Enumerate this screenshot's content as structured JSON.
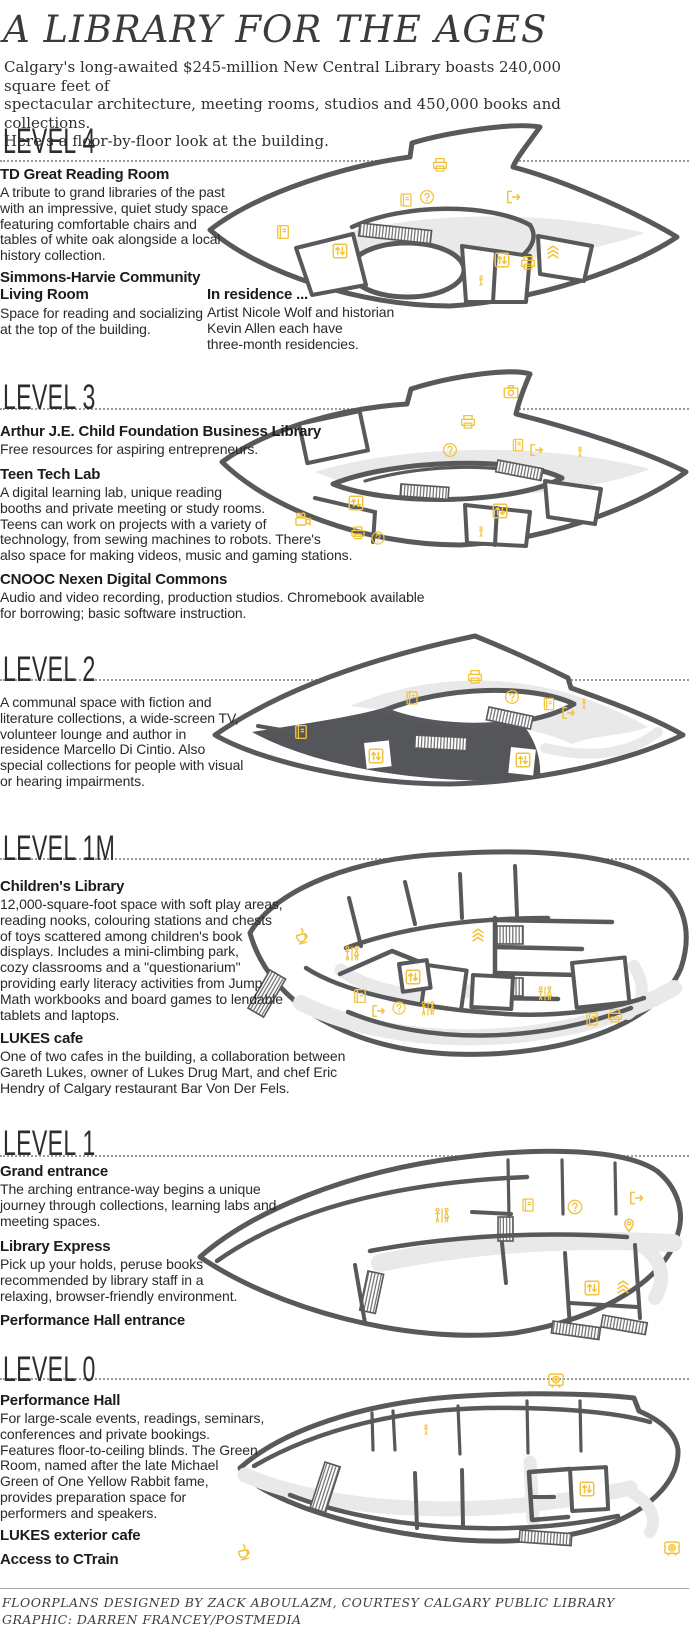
{
  "title": "A LIBRARY FOR THE AGES",
  "intro": "Calgary's long-awaited $245-million New Central Library boasts 240,000 square feet of\nspectacular architecture, meeting rooms, studios and 450,000 books and collections.\nHere's a floor-by-floor look at the building.",
  "colors": {
    "accent": "#f2c33c",
    "wall": "#58595b",
    "band": "#e9e9ea",
    "dark_fill": "#55565a"
  },
  "sections": [
    {
      "id": "level4",
      "label": "LEVEL 4",
      "blocks": [
        {
          "heading": "TD Great Reading Room",
          "body": "A tribute to grand libraries of the past\nwith an impressive, quiet study space\nfeaturing comfortable chairs and\ntables of white oak alongside a local\nhistory collection."
        },
        {
          "heading": "Simmons-Harvie Community\nLiving Room",
          "body": "Space for reading and socializing\nat the top of the building."
        },
        {
          "heading": "In residence ...",
          "body": "Artist Nicole Wolf and historian\nKevin Allen each have\nthree-month residencies."
        }
      ],
      "icons": [
        {
          "type": "printer",
          "x": 240,
          "y": 50,
          "s": 18
        },
        {
          "type": "book",
          "x": 206,
          "y": 85,
          "s": 17
        },
        {
          "type": "question",
          "x": 227,
          "y": 82,
          "s": 17
        },
        {
          "type": "exit",
          "x": 313,
          "y": 82,
          "s": 18
        },
        {
          "type": "book",
          "x": 83,
          "y": 117,
          "s": 18
        },
        {
          "type": "elevator",
          "x": 140,
          "y": 136,
          "s": 19
        },
        {
          "type": "elevator",
          "x": 302,
          "y": 145,
          "s": 19
        },
        {
          "type": "printer",
          "x": 328,
          "y": 148,
          "s": 18
        },
        {
          "type": "stairs",
          "x": 353,
          "y": 136,
          "s": 18
        },
        {
          "type": "person",
          "x": 281,
          "y": 166,
          "s": 13
        }
      ]
    },
    {
      "id": "level3",
      "label": "LEVEL 3",
      "blocks": [
        {
          "heading": "Arthur J.E. Child Foundation Business Library",
          "body": "Free resources for aspiring entrepreneurs."
        },
        {
          "heading": "Teen Tech Lab",
          "body": "A digital learning lab, unique reading\nbooths and private meeting or study rooms.\nTeens can work on projects with a variety of\ntechnology, from sewing machines to robots. There's\nalso space for making videos, music and gaming stations."
        },
        {
          "heading": "CNOOC Nexen Digital Commons",
          "body": "Audio and video recording, production studios. Chromebook available\nfor borrowing; basic software instruction."
        }
      ],
      "icons": [
        {
          "type": "camera",
          "x": 296,
          "y": 30,
          "s": 19
        },
        {
          "type": "printer",
          "x": 253,
          "y": 60,
          "s": 18
        },
        {
          "type": "question",
          "x": 235,
          "y": 88,
          "s": 17
        },
        {
          "type": "book",
          "x": 303,
          "y": 83,
          "s": 16
        },
        {
          "type": "exit",
          "x": 321,
          "y": 88,
          "s": 17
        },
        {
          "type": "person",
          "x": 365,
          "y": 90,
          "s": 13
        },
        {
          "type": "elevator",
          "x": 141,
          "y": 141,
          "s": 19
        },
        {
          "type": "elevator",
          "x": 285,
          "y": 149,
          "s": 19
        },
        {
          "type": "video",
          "x": 88,
          "y": 158,
          "s": 20
        },
        {
          "type": "printer",
          "x": 143,
          "y": 171,
          "s": 17
        },
        {
          "type": "question",
          "x": 163,
          "y": 176,
          "s": 16
        },
        {
          "type": "person",
          "x": 266,
          "y": 170,
          "s": 13
        }
      ]
    },
    {
      "id": "level2",
      "label": "LEVEL 2",
      "blocks": [
        {
          "heading": "",
          "body": "A communal space with fiction and\nliterature collections, a wide-screen TV,\nvolunteer lounge and author in\nresidence Marcello Di Cintio. Also\nspecial collections for people with visual\nor hearing impairments."
        }
      ],
      "icons": [
        {
          "type": "printer",
          "x": 275,
          "y": 67,
          "s": 18
        },
        {
          "type": "book",
          "x": 212,
          "y": 88,
          "s": 17
        },
        {
          "type": "question",
          "x": 312,
          "y": 87,
          "s": 17
        },
        {
          "type": "book",
          "x": 349,
          "y": 94,
          "s": 16
        },
        {
          "type": "exit",
          "x": 368,
          "y": 103,
          "s": 17
        },
        {
          "type": "person",
          "x": 384,
          "y": 94,
          "s": 13
        },
        {
          "type": "book",
          "x": 101,
          "y": 122,
          "s": 18
        },
        {
          "type": "elevator",
          "x": 176,
          "y": 146,
          "s": 19
        },
        {
          "type": "elevator",
          "x": 323,
          "y": 150,
          "s": 19
        }
      ]
    },
    {
      "id": "level1m",
      "label": "LEVEL 1M",
      "blocks": [
        {
          "heading": "Children's Library",
          "body": "12,000-square-foot space with soft play areas,\nreading nooks, colouring stations and chests\nof toys scattered among children's book\ndisplays. Includes a mini-climbing park,\ncozy classrooms and a \"questionarium\"\nproviding early literacy activities from Jump\nMath workbooks and board games to lendable\ntablets and laptops."
        },
        {
          "heading": "LUKES cafe",
          "body": "One of two cafes in the building, a collaboration between\nGareth Lukes, owner of Lukes Drug Mart, and chef Eric\nHendry of Calgary restaurant Bar Von Der Fels."
        }
      ],
      "icons": [
        {
          "type": "coffee",
          "x": 56,
          "y": 88,
          "s": 20
        },
        {
          "type": "washroom",
          "x": 106,
          "y": 106,
          "s": 20
        },
        {
          "type": "stairs",
          "x": 232,
          "y": 86,
          "s": 18
        },
        {
          "type": "elevator",
          "x": 167,
          "y": 129,
          "s": 19
        },
        {
          "type": "book",
          "x": 114,
          "y": 148,
          "s": 18
        },
        {
          "type": "exit",
          "x": 132,
          "y": 163,
          "s": 17
        },
        {
          "type": "question",
          "x": 153,
          "y": 160,
          "s": 16
        },
        {
          "type": "washroom",
          "x": 182,
          "y": 161,
          "s": 19
        },
        {
          "type": "washroom",
          "x": 299,
          "y": 146,
          "s": 19
        },
        {
          "type": "book",
          "x": 346,
          "y": 171,
          "s": 17
        },
        {
          "type": "printer",
          "x": 369,
          "y": 168,
          "s": 18
        }
      ]
    },
    {
      "id": "level1",
      "label": "LEVEL 1",
      "blocks": [
        {
          "heading": "Grand entrance",
          "body": "The arching entrance-way begins a unique\njourney through collections, learning labs and\nmeeting spaces."
        },
        {
          "heading": "Library Express",
          "body": "Pick up your holds, peruse books\nrecommended by library staff in a\nrelaxing, browser-friendly environment."
        },
        {
          "heading": "Performance Hall entrance",
          "body": ""
        }
      ],
      "icons": [
        {
          "type": "washroom",
          "x": 247,
          "y": 123,
          "s": 20
        },
        {
          "type": "book",
          "x": 333,
          "y": 112,
          "s": 17
        },
        {
          "type": "question",
          "x": 380,
          "y": 114,
          "s": 18
        },
        {
          "type": "exit",
          "x": 441,
          "y": 105,
          "s": 18
        },
        {
          "type": "pin",
          "x": 434,
          "y": 132,
          "s": 18
        },
        {
          "type": "elevator",
          "x": 397,
          "y": 195,
          "s": 19
        },
        {
          "type": "stairs",
          "x": 428,
          "y": 193,
          "s": 18
        }
      ]
    },
    {
      "id": "level0",
      "label": "LEVEL 0",
      "blocks": [
        {
          "heading": "Performance Hall",
          "body": "For large-scale events, readings, seminars,\nconferences and private bookings.\nFeatures floor-to-ceiling blinds. The Green\nRoom, named after the late Michael\nGreen of One Yellow Rabbit fame,\nprovides preparation space for\nperformers and speakers."
        },
        {
          "heading": "LUKES exterior cafe",
          "body": ""
        },
        {
          "heading": "Access to CTrain",
          "body": ""
        }
      ],
      "icons": [
        {
          "type": "ctrain",
          "x": 326,
          "y": 10,
          "s": 20
        },
        {
          "type": "person",
          "x": 196,
          "y": 60,
          "s": 13
        },
        {
          "type": "elevator",
          "x": 357,
          "y": 119,
          "s": 19
        },
        {
          "type": "coffee",
          "x": 14,
          "y": 182,
          "s": 20
        },
        {
          "type": "ctrain",
          "x": 442,
          "y": 178,
          "s": 20
        }
      ]
    }
  ],
  "footer": {
    "line1": "FLOORPLANS DESIGNED BY ZACK ABOULAZM, COURTESY CALGARY PUBLIC LIBRARY",
    "line2": "GRAPHIC: DARREN FRANCEY/POSTMEDIA"
  }
}
